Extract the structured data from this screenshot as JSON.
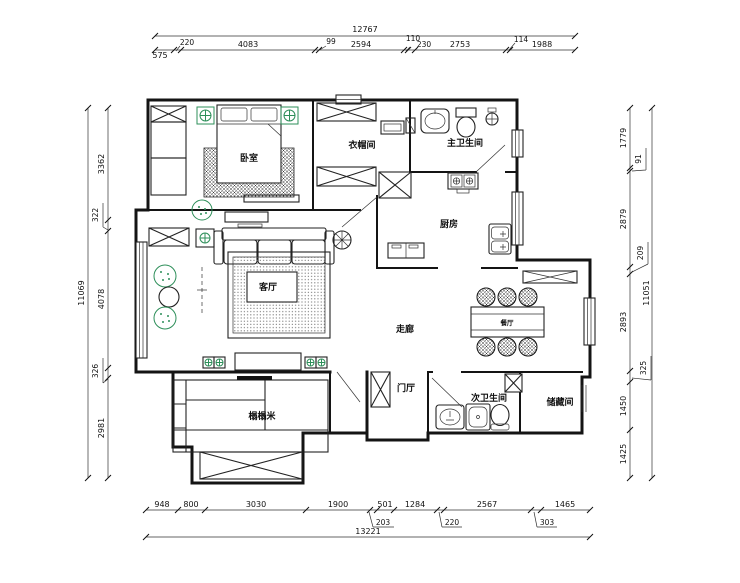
{
  "title": "apartment-floor-plan",
  "colors": {
    "line": "#141414",
    "accent_green": "#2e8f5a",
    "dim_text": "#111111"
  },
  "rooms": {
    "bedroom": "卧室",
    "cloakroom": "衣帽间",
    "master_bath": "主卫生间",
    "kitchen": "厨房",
    "living": "客厅",
    "corridor": "走廊",
    "dining": "餐厅",
    "foyer": "门厅",
    "second_bath": "次卫生间",
    "storage": "储藏间",
    "tatami": "榻榻米"
  },
  "dimensions": {
    "top": {
      "total": "12767",
      "segments": [
        "575",
        "220",
        "4083",
        "99",
        "2594",
        "110",
        "230",
        "2753",
        "114",
        "1988"
      ]
    },
    "bottom": {
      "total": "13221",
      "segments": [
        "948",
        "800",
        "3030",
        "1900",
        "501",
        "1284",
        "2567",
        "1465"
      ],
      "leaders": [
        "203",
        "220",
        "303"
      ]
    },
    "left": {
      "total": "11069",
      "segments": [
        "3362",
        "322",
        "4078",
        "326",
        "2981"
      ]
    },
    "right": {
      "total": "11051",
      "segments": [
        "1779",
        "2879",
        "2893",
        "1450",
        "1425"
      ],
      "leaders": [
        "91",
        "209",
        "325"
      ]
    }
  }
}
